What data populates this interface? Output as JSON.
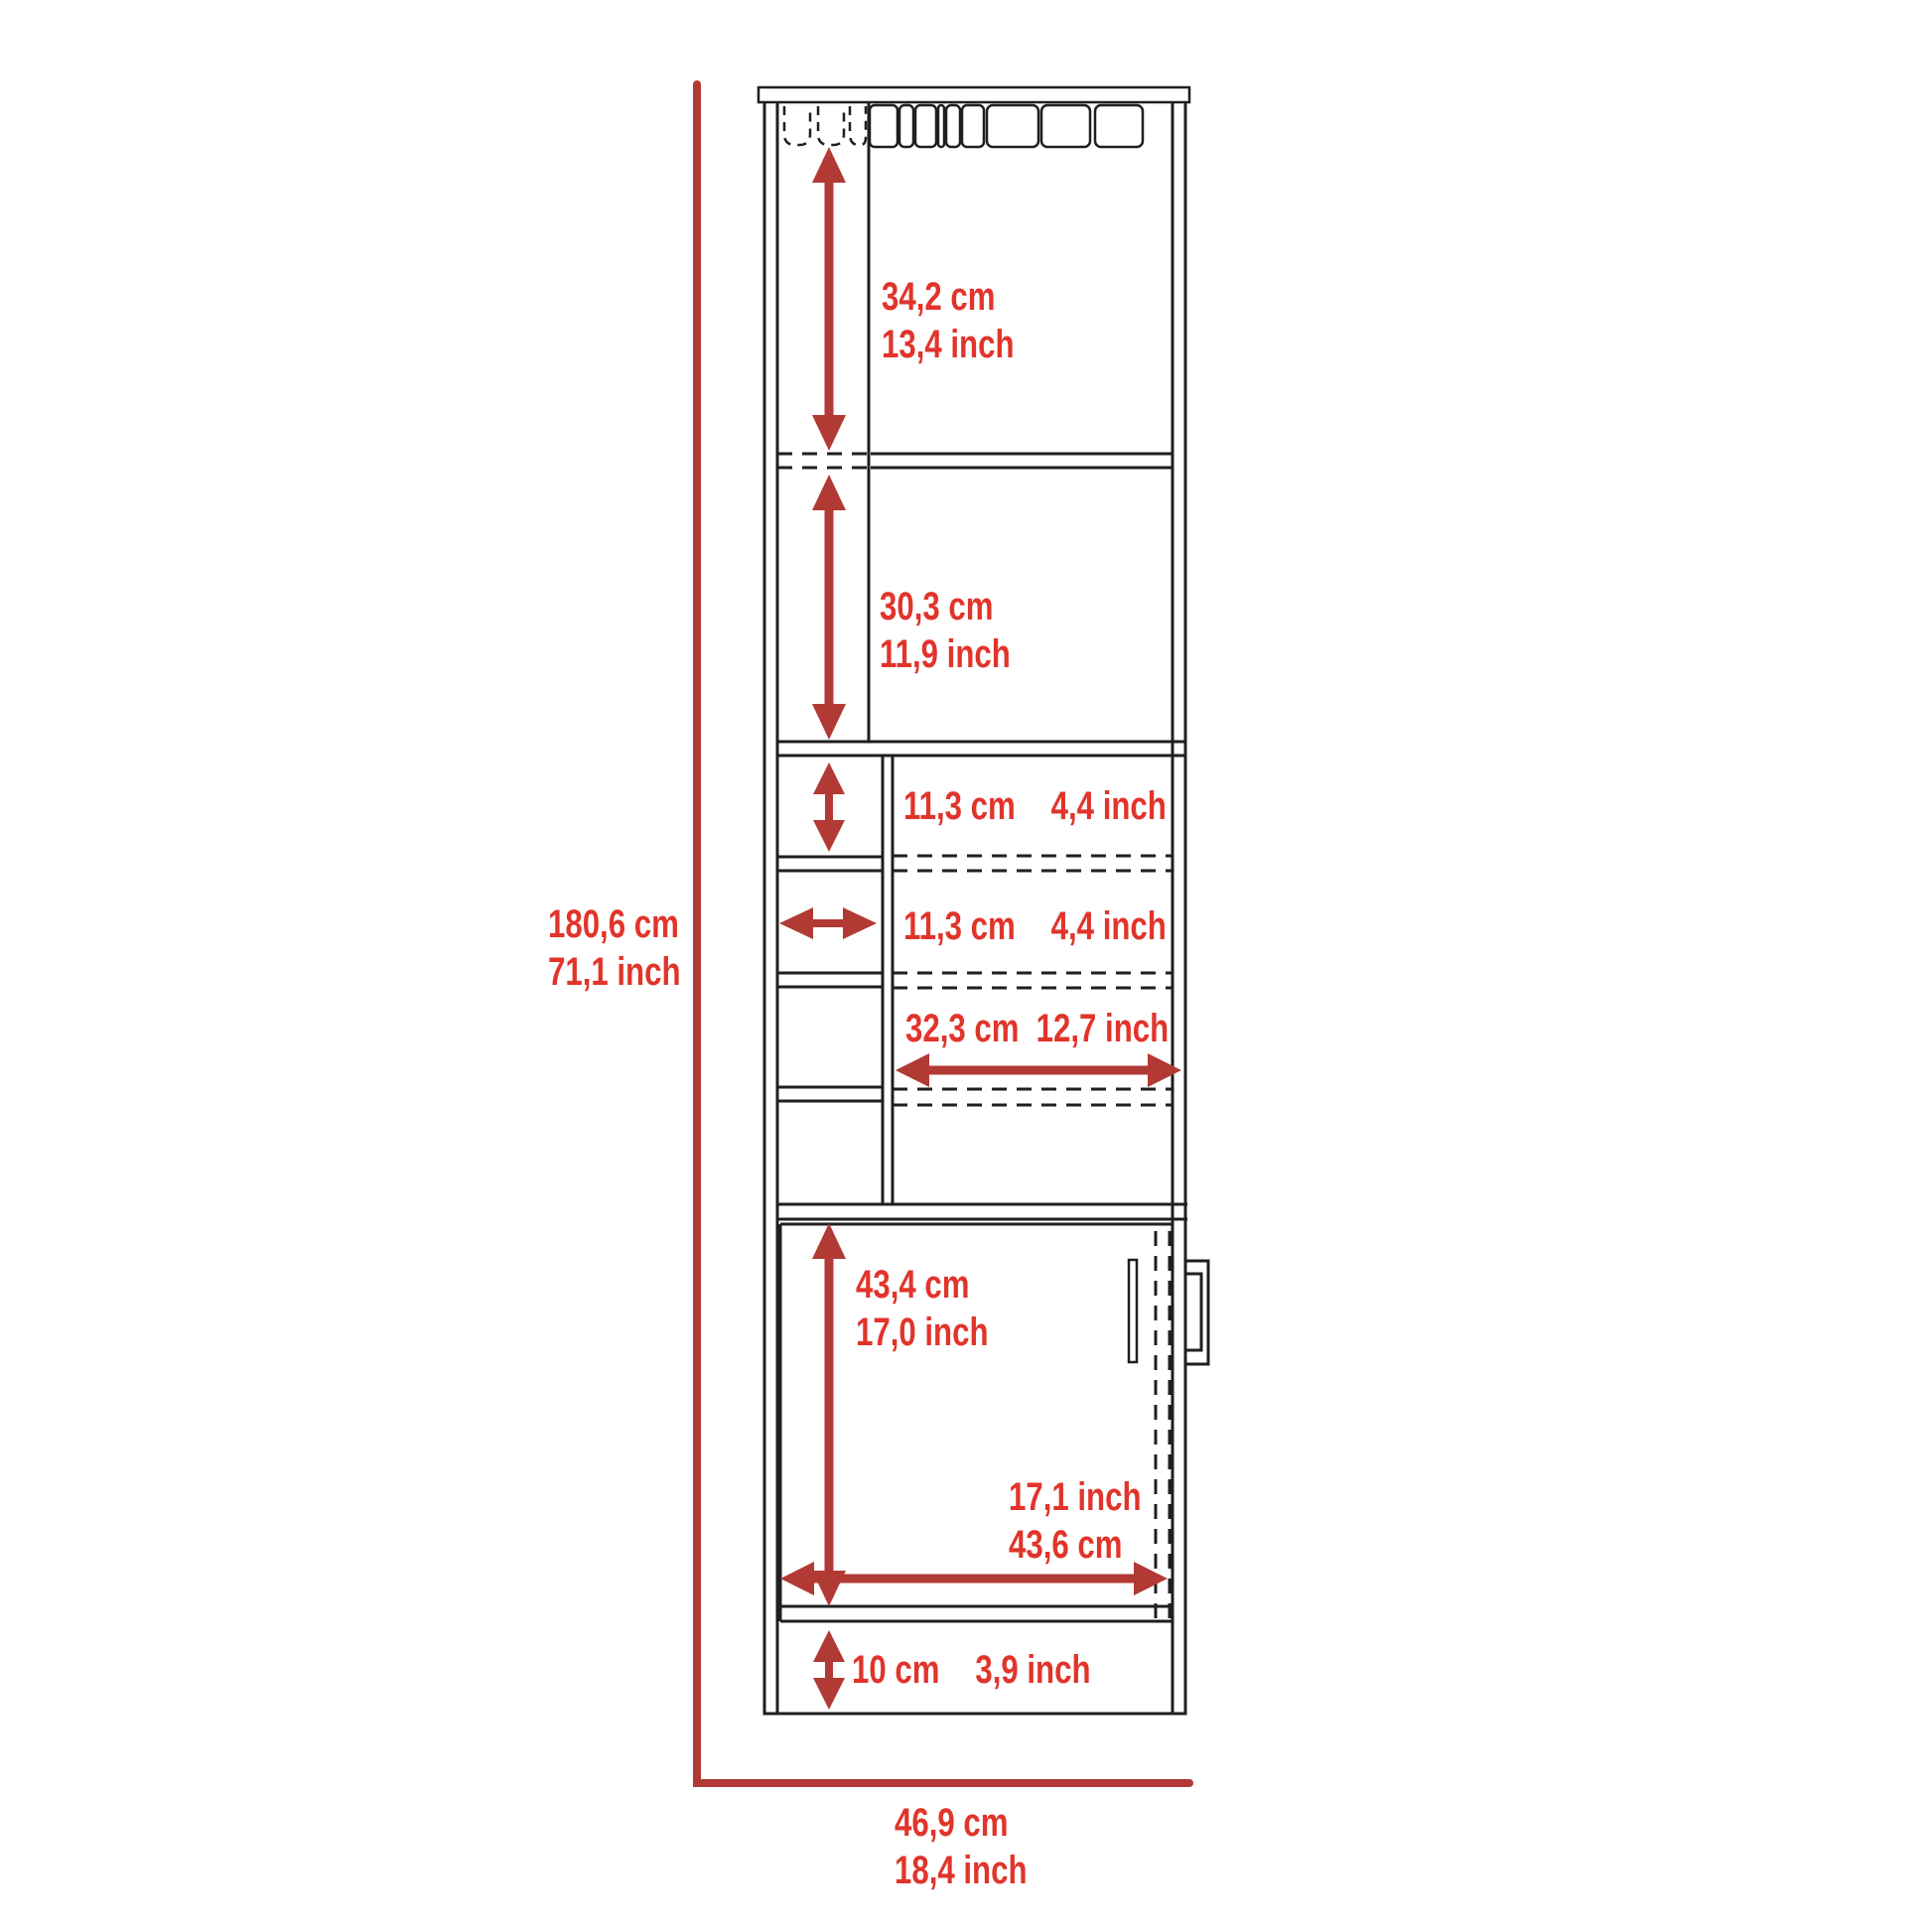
{
  "diagram": {
    "kind": "furniture-dimension-diagram",
    "units_shown": [
      "cm",
      "inch"
    ]
  },
  "colors": {
    "background": "#ffffff",
    "ink": "#1f1f1f",
    "dimension_red": "#b23a34",
    "label_red": "#e1342b"
  },
  "dimensions": {
    "total_height": {
      "cm": "180,6 cm",
      "inch": "71,1 inch"
    },
    "top_section_height": {
      "cm": "34,2 cm",
      "inch": "13,4 inch"
    },
    "second_section_height": {
      "cm": "30,3 cm",
      "inch": "11,9 inch"
    },
    "cubby_height": {
      "cm": "11,3 cm",
      "inch": "4,4 inch"
    },
    "cubby_width": {
      "cm": "11,3 cm",
      "inch": "4,4 inch"
    },
    "inner_shelf_width": {
      "cm": "32,3 cm",
      "inch": "12,7 inch"
    },
    "door_height": {
      "cm": "43,4 cm",
      "inch": "17,0 inch"
    },
    "door_width": {
      "inch": "17,1 inch",
      "cm": "43,6 cm"
    },
    "base_height": {
      "cm": "10 cm",
      "inch": "3,9 inch"
    },
    "total_width": {
      "cm": "46,9 cm",
      "inch": "18,4 inch"
    }
  }
}
